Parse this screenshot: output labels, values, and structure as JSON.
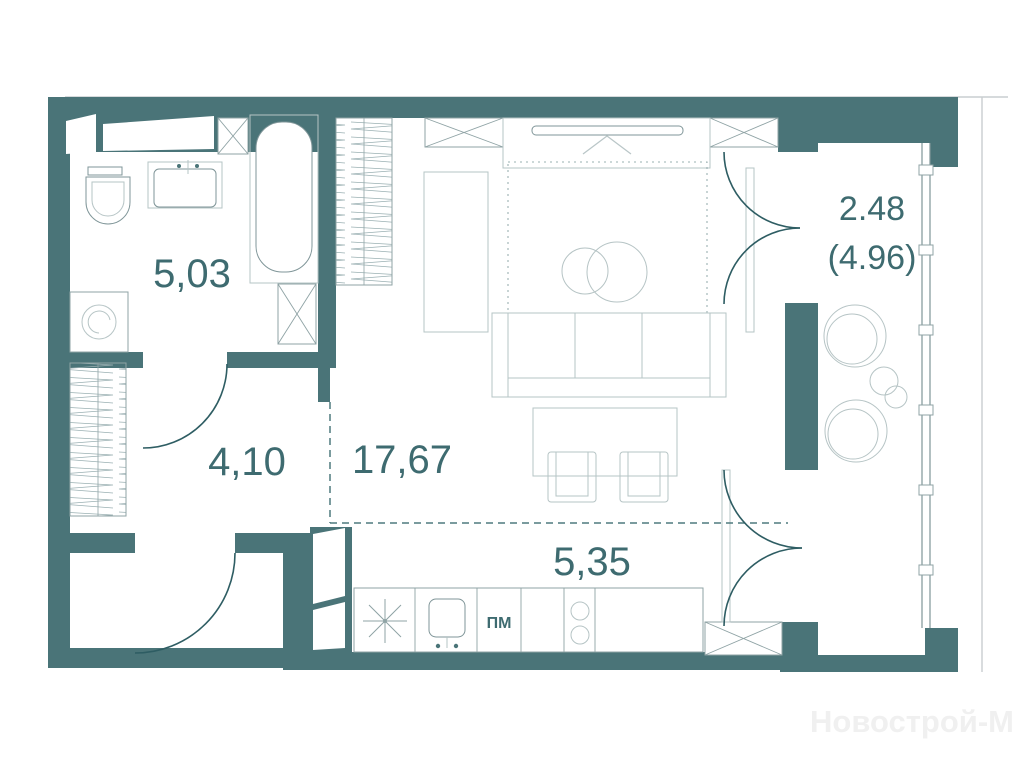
{
  "plan": {
    "watermark": "Новострой-М",
    "rooms": {
      "bathroom": {
        "area_label": "5,03"
      },
      "hallway": {
        "area_label": "4,10"
      },
      "living": {
        "area_label": "17,67"
      },
      "kitchen": {
        "area_label": "5,35"
      },
      "balcony": {
        "area_label": "2.48",
        "area_label_total": "(4.96)"
      }
    },
    "appliances": {
      "dishwasher_label": "ПМ"
    },
    "icons": {
      "fridge_marker": "eight-point-asterisk",
      "bathroom_fixtures": [
        "toilet",
        "sink-vanity",
        "bathtub",
        "washing-machine"
      ],
      "living_fixtures": [
        "tv-panel",
        "sofa",
        "rug",
        "coffee-tables",
        "dining-table",
        "chairs",
        "wardrobe-hatched"
      ],
      "balcony_fixtures": [
        "lounge-chairs",
        "side-table"
      ],
      "doors": [
        "bathroom-door-arc",
        "entrance-door-arc",
        "french-door-top",
        "french-door-bottom"
      ]
    },
    "colors": {
      "wall": "#4A7478",
      "label_text": "#3E6B70",
      "furniture_line": "#7F9598",
      "envelope_line": "#C9CED0",
      "watermark": "#F0F0F0"
    }
  }
}
